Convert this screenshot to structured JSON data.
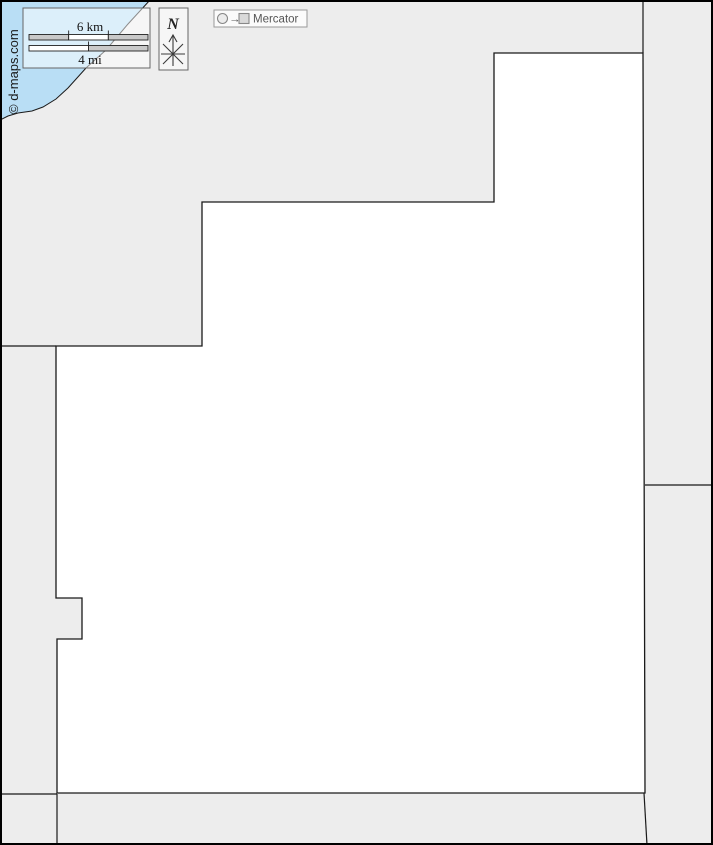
{
  "colors": {
    "water": "#b9def5",
    "land": "#ededed",
    "subject_region": "#ffffff",
    "boundary": "#1a1a1a",
    "frame": "#000000",
    "scale_segment_gray": "#c9c9c9",
    "scale_segment_white": "#ffffff"
  },
  "scale_bar": {
    "km_label": "6 km",
    "mi_label": "4 mi"
  },
  "compass": {
    "north_label": "N"
  },
  "projection": {
    "name": "Mercator",
    "arrow_glyph": "→"
  },
  "copyright": "© d-maps.com"
}
